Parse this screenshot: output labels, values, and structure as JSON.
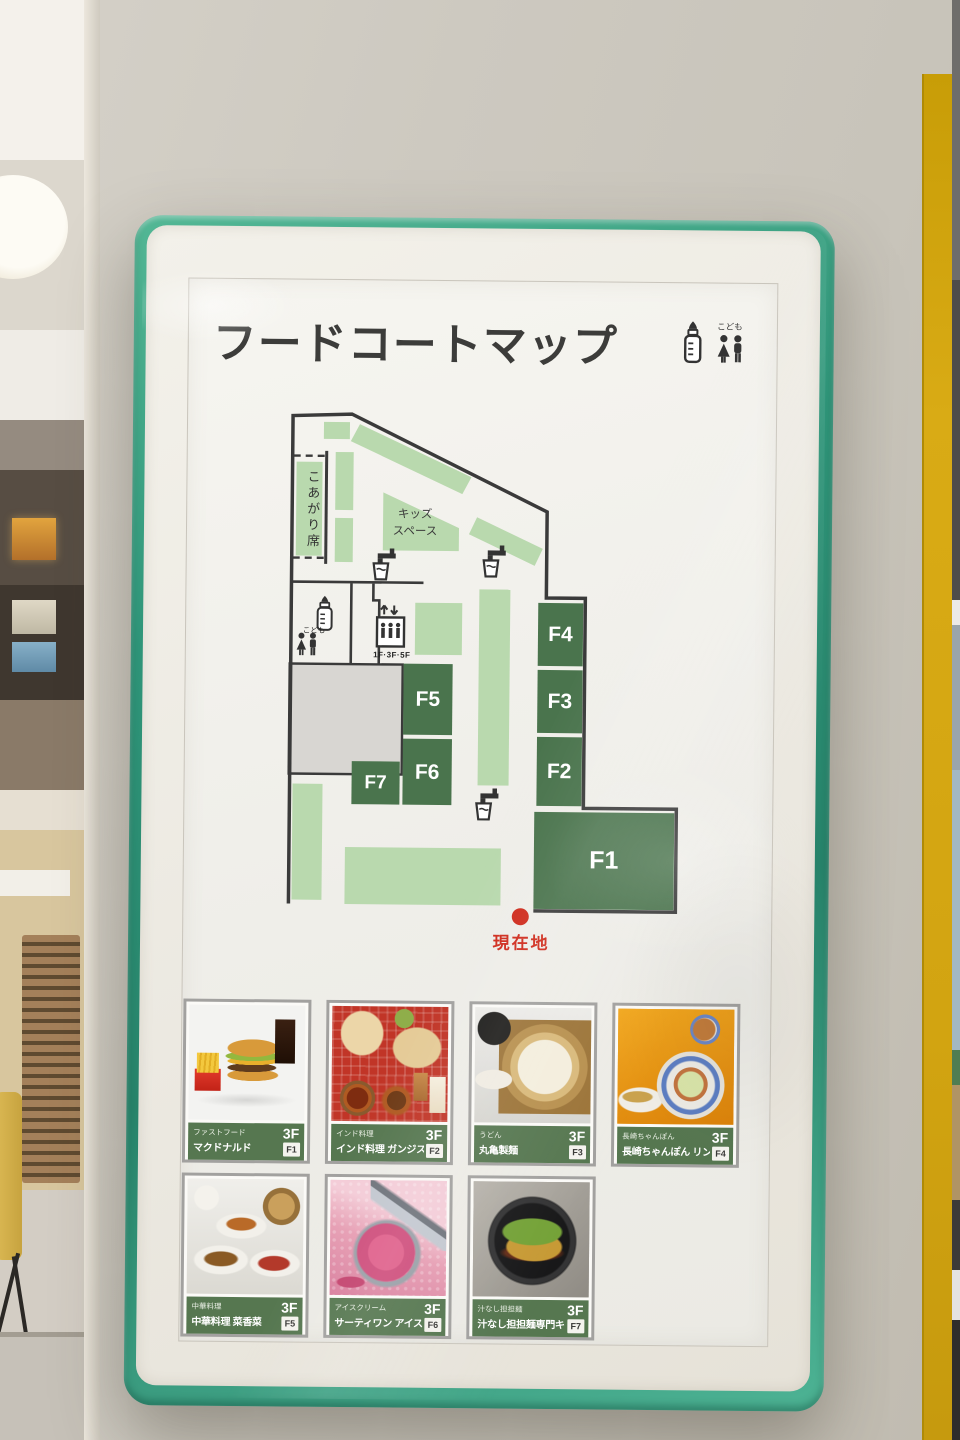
{
  "sign": {
    "title": "フードコートマップ",
    "header": {
      "kids_label": "こども"
    },
    "map": {
      "koagari": "こあがり席",
      "kids_space": [
        "キッズ",
        "スペース"
      ],
      "kids_toilet": "こども",
      "elevator_floors": "1F·3F·5F",
      "current_location": "現在地",
      "stalls": {
        "f1": "F1",
        "f2": "F2",
        "f3": "F3",
        "f4": "F4",
        "f5": "F5",
        "f6": "F6",
        "f7": "F7"
      }
    },
    "cards": [
      {
        "category": "ファストフード",
        "name": "マクドナルド",
        "floor": "3F",
        "unit": "F1",
        "photo": "mcd"
      },
      {
        "category": "インド料理",
        "name": "インド料理 ガンジス川",
        "floor": "3F",
        "unit": "F2",
        "photo": "india"
      },
      {
        "category": "うどん",
        "name": "丸亀製麺",
        "floor": "3F",
        "unit": "F3",
        "photo": "udon"
      },
      {
        "category": "長崎ちゃんぽん",
        "name": "長崎ちゃんぽん リンガーハット",
        "floor": "3F",
        "unit": "F4",
        "photo": "champon"
      },
      {
        "category": "中華料理",
        "name": "中華料理 菜香菜",
        "floor": "3F",
        "unit": "F5",
        "photo": "chinese"
      },
      {
        "category": "アイスクリーム",
        "name": "サーティワン アイスクリーム",
        "floor": "3F",
        "unit": "F6",
        "photo": "ice"
      },
      {
        "category": "汁なし担担麺",
        "name": "汁なし担担麺専門キング軒",
        "floor": "3F",
        "unit": "F7",
        "photo": "dandan"
      }
    ],
    "colors": {
      "frame_teal": "#2f9579",
      "map_dark_green": "#4a744d",
      "map_light_green": "#b9d9ae",
      "card_band_green": "#567750",
      "accent_red": "#cf2a1b",
      "pillar_yellow": "#d2a411"
    }
  }
}
